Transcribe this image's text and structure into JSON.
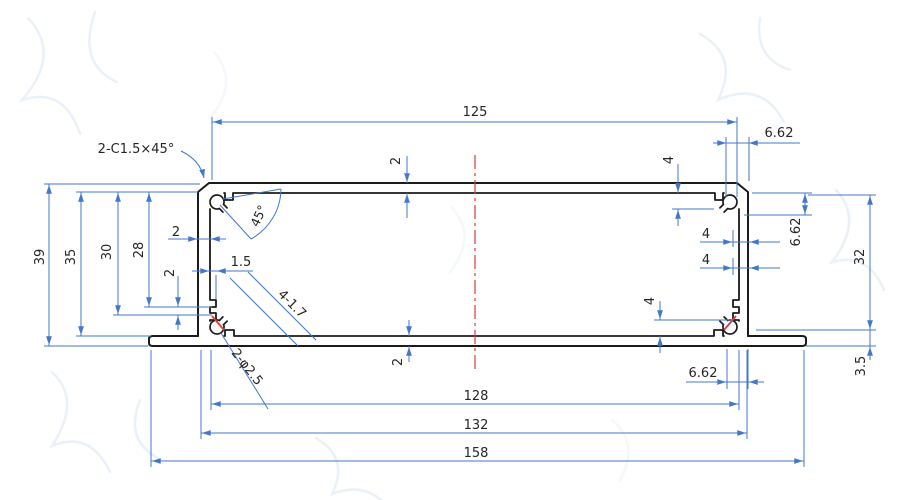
{
  "drawing": {
    "kind": "extrusion-profile-cross-section",
    "labels": {
      "chamfer_note": "2-C1.5×45°",
      "corner_angle": "45°",
      "dim_125": "125",
      "dim_662_top": "6.62",
      "dim_2_top": "2",
      "dim_4_top": "4",
      "dim_39": "39",
      "dim_35": "35",
      "dim_30": "30",
      "dim_28": "28",
      "dim_2_wall": "2",
      "dim_2_pitch": "2",
      "dim_1_5": "1.5",
      "note_screw_channels": "4-1.7",
      "note_holes": "2-φ2.5",
      "dim_4_right_upper": "4",
      "dim_4_right_lower": "4",
      "dim_662_right": "6.62",
      "dim_32": "32",
      "dim_4_bottom_right": "4",
      "dim_2_bottom": "2",
      "dim_662_bottom": "6.62",
      "dim_3_5": "3.5",
      "dim_128": "128",
      "dim_132": "132",
      "dim_158": "158"
    },
    "colors": {
      "profile": "#1b1b1b",
      "dimension": "#4377c9",
      "centerline": "#e03a3a",
      "text": "#262626",
      "background": "#ffffff",
      "watermark": "#d8e5f4"
    }
  }
}
